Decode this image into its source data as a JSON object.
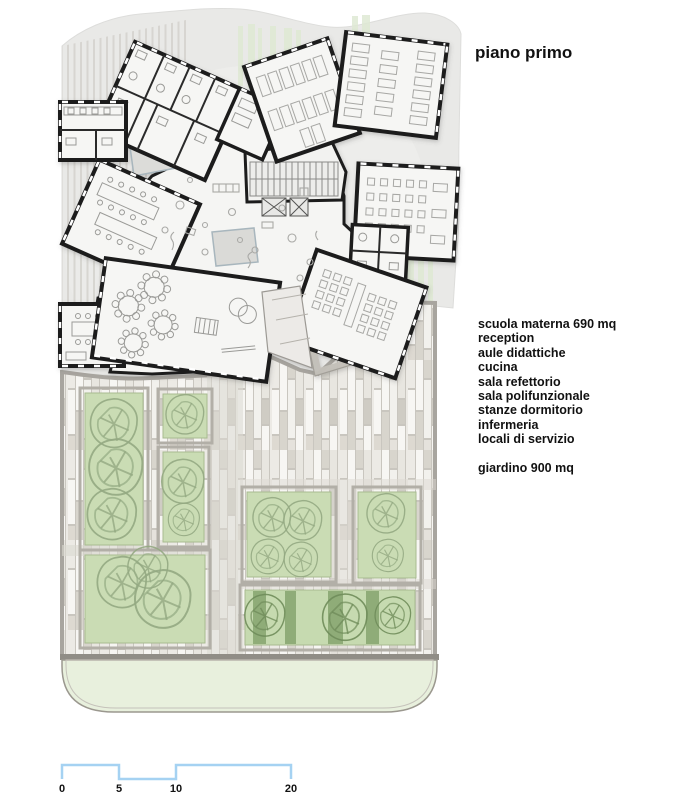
{
  "title": "piano primo",
  "legend": {
    "items": [
      "scuola materna 690 mq",
      "reception",
      "aule didattiche",
      "cucina",
      "sala refettorio",
      "sala polifunzionale",
      "stanze dormitorio",
      "infermeria",
      "locali di servizio"
    ],
    "garden": "giardino 900 mq"
  },
  "scale_bar": {
    "labels": [
      "0",
      "5",
      "10",
      "20"
    ],
    "unit_px_per_meter": 11.45,
    "color": "#a5d2f2"
  },
  "drawing": {
    "type": "architectural-floor-plan",
    "floor": "first floor",
    "building_fill": "#f5f5f3",
    "wall_color": "#1c1c1c",
    "paper_color": "#e9e9e7",
    "paving_colors": [
      "#f7f6f3",
      "#eceae5",
      "#d8d5cd",
      "#cfccc4",
      "#e8e6e0"
    ],
    "garden_green": "#cadcb4",
    "dark_green_stripe": "#8aa873",
    "lawn_band": "#e8f0dd",
    "tree_stroke": "#93a982"
  }
}
